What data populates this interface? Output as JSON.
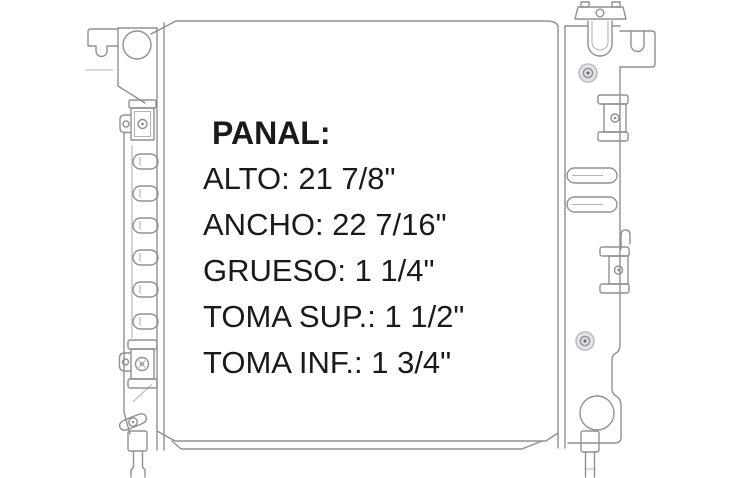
{
  "page": {
    "background": "#ffffff"
  },
  "drawing": {
    "subject": "radiator technical line drawing",
    "line_color": "#8f8f97",
    "light_line_color": "#b3b3ba"
  },
  "specs": {
    "heading": "PANAL:",
    "lines": [
      "ALTO: 21 7/8\"",
      "ANCHO: 22 7/16\"",
      "GRUESO: 1 1/4\"",
      "TOMA SUP.: 1 1/2\"",
      "TOMA INF.: 1 3/4\""
    ],
    "text_color": "#1a1a1c"
  }
}
